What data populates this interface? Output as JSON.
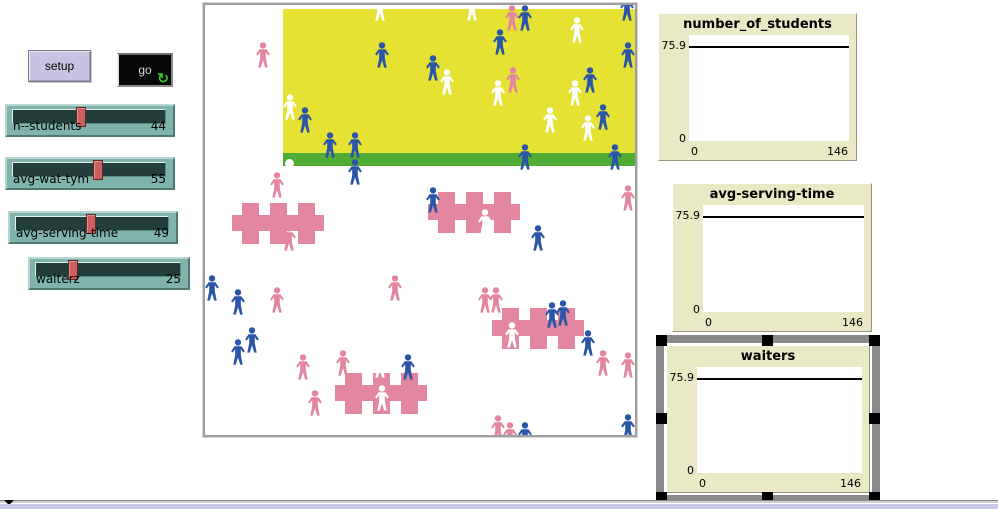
{
  "colors": {
    "button_lavender": "#C7C4E2",
    "go_button_bg": "#060606",
    "go_icon_green": "#2ECC2E",
    "slider_teal": "#7FB3AC",
    "slider_handle_red": "#C9605E",
    "world_yellow": "#E5E234",
    "world_green": "#4FAC34",
    "person_pink": "#E2879F",
    "person_blue": "#2B55A8",
    "person_white": "#FFFFFF",
    "plot_tan": "#E9E9C6",
    "selection_gray": "#8A8A8A",
    "scrollbar_lavender": "#C8C8E8"
  },
  "buttons": {
    "setup_label": "setup",
    "go_label": "go",
    "go_icon": "↻"
  },
  "sliders": [
    {
      "label": "n--students",
      "value": "44",
      "pct": 44
    },
    {
      "label": "avg-wat-tym",
      "value": "55",
      "pct": 55
    },
    {
      "label": "avg-serving-time",
      "value": "49",
      "pct": 49
    },
    {
      "label": "waiterz",
      "value": "25",
      "pct": 25
    }
  ],
  "world": {
    "regions": {
      "yellow": {
        "x": 78,
        "y": 4,
        "w": 352,
        "h": 144
      },
      "green": {
        "x": 78,
        "y": 148,
        "w": 352,
        "h": 13
      }
    },
    "tables": [
      {
        "x": 27,
        "y": 198
      },
      {
        "x": 223,
        "y": 187
      },
      {
        "x": 130,
        "y": 368
      },
      {
        "x": 287,
        "y": 303
      }
    ],
    "dots": [
      {
        "x": 84,
        "y": 158,
        "c": "white"
      }
    ],
    "people": [
      {
        "x": 58,
        "y": 50,
        "c": "pink"
      },
      {
        "x": 85,
        "y": 102,
        "c": "white"
      },
      {
        "x": 100,
        "y": 115,
        "c": "blue"
      },
      {
        "x": 125,
        "y": 140,
        "c": "blue"
      },
      {
        "x": 150,
        "y": 140,
        "c": "blue"
      },
      {
        "x": 175,
        "y": 3,
        "c": "white"
      },
      {
        "x": 177,
        "y": 50,
        "c": "blue"
      },
      {
        "x": 228,
        "y": 63,
        "c": "blue"
      },
      {
        "x": 242,
        "y": 77,
        "c": "white"
      },
      {
        "x": 267,
        "y": 3,
        "c": "white"
      },
      {
        "x": 307,
        "y": 13,
        "c": "pink"
      },
      {
        "x": 320,
        "y": 13,
        "c": "blue"
      },
      {
        "x": 295,
        "y": 37,
        "c": "blue"
      },
      {
        "x": 308,
        "y": 75,
        "c": "pink"
      },
      {
        "x": 293,
        "y": 88,
        "c": "white"
      },
      {
        "x": 372,
        "y": 25,
        "c": "white"
      },
      {
        "x": 385,
        "y": 75,
        "c": "blue"
      },
      {
        "x": 370,
        "y": 88,
        "c": "white"
      },
      {
        "x": 345,
        "y": 115,
        "c": "white"
      },
      {
        "x": 398,
        "y": 112,
        "c": "blue"
      },
      {
        "x": 383,
        "y": 123,
        "c": "white"
      },
      {
        "x": 423,
        "y": 50,
        "c": "blue"
      },
      {
        "x": 422,
        "y": 3,
        "c": "blue"
      },
      {
        "x": 320,
        "y": 152,
        "c": "blue"
      },
      {
        "x": 410,
        "y": 152,
        "c": "blue"
      },
      {
        "x": 150,
        "y": 167,
        "c": "blue"
      },
      {
        "x": 72,
        "y": 180,
        "c": "pink"
      },
      {
        "x": 84,
        "y": 233,
        "c": "pink"
      },
      {
        "x": 228,
        "y": 195,
        "c": "blue"
      },
      {
        "x": 280,
        "y": 217,
        "c": "white"
      },
      {
        "x": 423,
        "y": 193,
        "c": "pink"
      },
      {
        "x": 333,
        "y": 233,
        "c": "blue"
      },
      {
        "x": 7,
        "y": 283,
        "c": "blue"
      },
      {
        "x": 33,
        "y": 297,
        "c": "blue"
      },
      {
        "x": 72,
        "y": 295,
        "c": "pink"
      },
      {
        "x": 190,
        "y": 283,
        "c": "pink"
      },
      {
        "x": 47,
        "y": 335,
        "c": "blue"
      },
      {
        "x": 33,
        "y": 347,
        "c": "blue"
      },
      {
        "x": 98,
        "y": 362,
        "c": "pink"
      },
      {
        "x": 138,
        "y": 358,
        "c": "pink"
      },
      {
        "x": 175,
        "y": 360,
        "c": "white"
      },
      {
        "x": 203,
        "y": 362,
        "c": "blue"
      },
      {
        "x": 110,
        "y": 398,
        "c": "pink"
      },
      {
        "x": 177,
        "y": 393,
        "c": "white"
      },
      {
        "x": 280,
        "y": 295,
        "c": "pink"
      },
      {
        "x": 291,
        "y": 295,
        "c": "pink"
      },
      {
        "x": 347,
        "y": 310,
        "c": "blue"
      },
      {
        "x": 358,
        "y": 308,
        "c": "blue"
      },
      {
        "x": 307,
        "y": 330,
        "c": "white"
      },
      {
        "x": 383,
        "y": 338,
        "c": "blue"
      },
      {
        "x": 398,
        "y": 358,
        "c": "pink"
      },
      {
        "x": 423,
        "y": 360,
        "c": "pink"
      },
      {
        "x": 293,
        "y": 423,
        "c": "pink"
      },
      {
        "x": 305,
        "y": 430,
        "c": "pink"
      },
      {
        "x": 320,
        "y": 430,
        "c": "blue"
      },
      {
        "x": 423,
        "y": 422,
        "c": "blue"
      }
    ]
  },
  "plots": [
    {
      "title": "number_of_students",
      "y_max": "75.9",
      "y_min": "0",
      "x_min": "0",
      "x_max": "146",
      "selected": false
    },
    {
      "title": "avg-serving-time",
      "y_max": "75.9",
      "y_min": "0",
      "x_min": "0",
      "x_max": "146",
      "selected": false
    },
    {
      "title": "waiters",
      "y_max": "75.9",
      "y_min": "0",
      "x_min": "0",
      "x_max": "146",
      "selected": true
    }
  ],
  "chart_data": [
    {
      "type": "line",
      "title": "number_of_students",
      "xlabel": "",
      "ylabel": "",
      "xlim": [
        0,
        146
      ],
      "ylim": [
        0,
        75.9
      ],
      "grid": false,
      "legend": "none",
      "series": [
        {
          "name": "pen-0",
          "x": [
            0,
            146
          ],
          "y": [
            75.9,
            75.9
          ]
        }
      ]
    },
    {
      "type": "line",
      "title": "avg-serving-time",
      "xlabel": "",
      "ylabel": "",
      "xlim": [
        0,
        146
      ],
      "ylim": [
        0,
        75.9
      ],
      "grid": false,
      "legend": "none",
      "series": [
        {
          "name": "pen-0",
          "x": [
            0,
            146
          ],
          "y": [
            75.9,
            75.9
          ]
        }
      ]
    },
    {
      "type": "line",
      "title": "waiters",
      "xlabel": "",
      "ylabel": "",
      "xlim": [
        0,
        146
      ],
      "ylim": [
        0,
        75.9
      ],
      "grid": false,
      "legend": "none",
      "series": [
        {
          "name": "pen-0",
          "x": [
            0,
            146
          ],
          "y": [
            75.9,
            75.9
          ]
        }
      ]
    }
  ]
}
